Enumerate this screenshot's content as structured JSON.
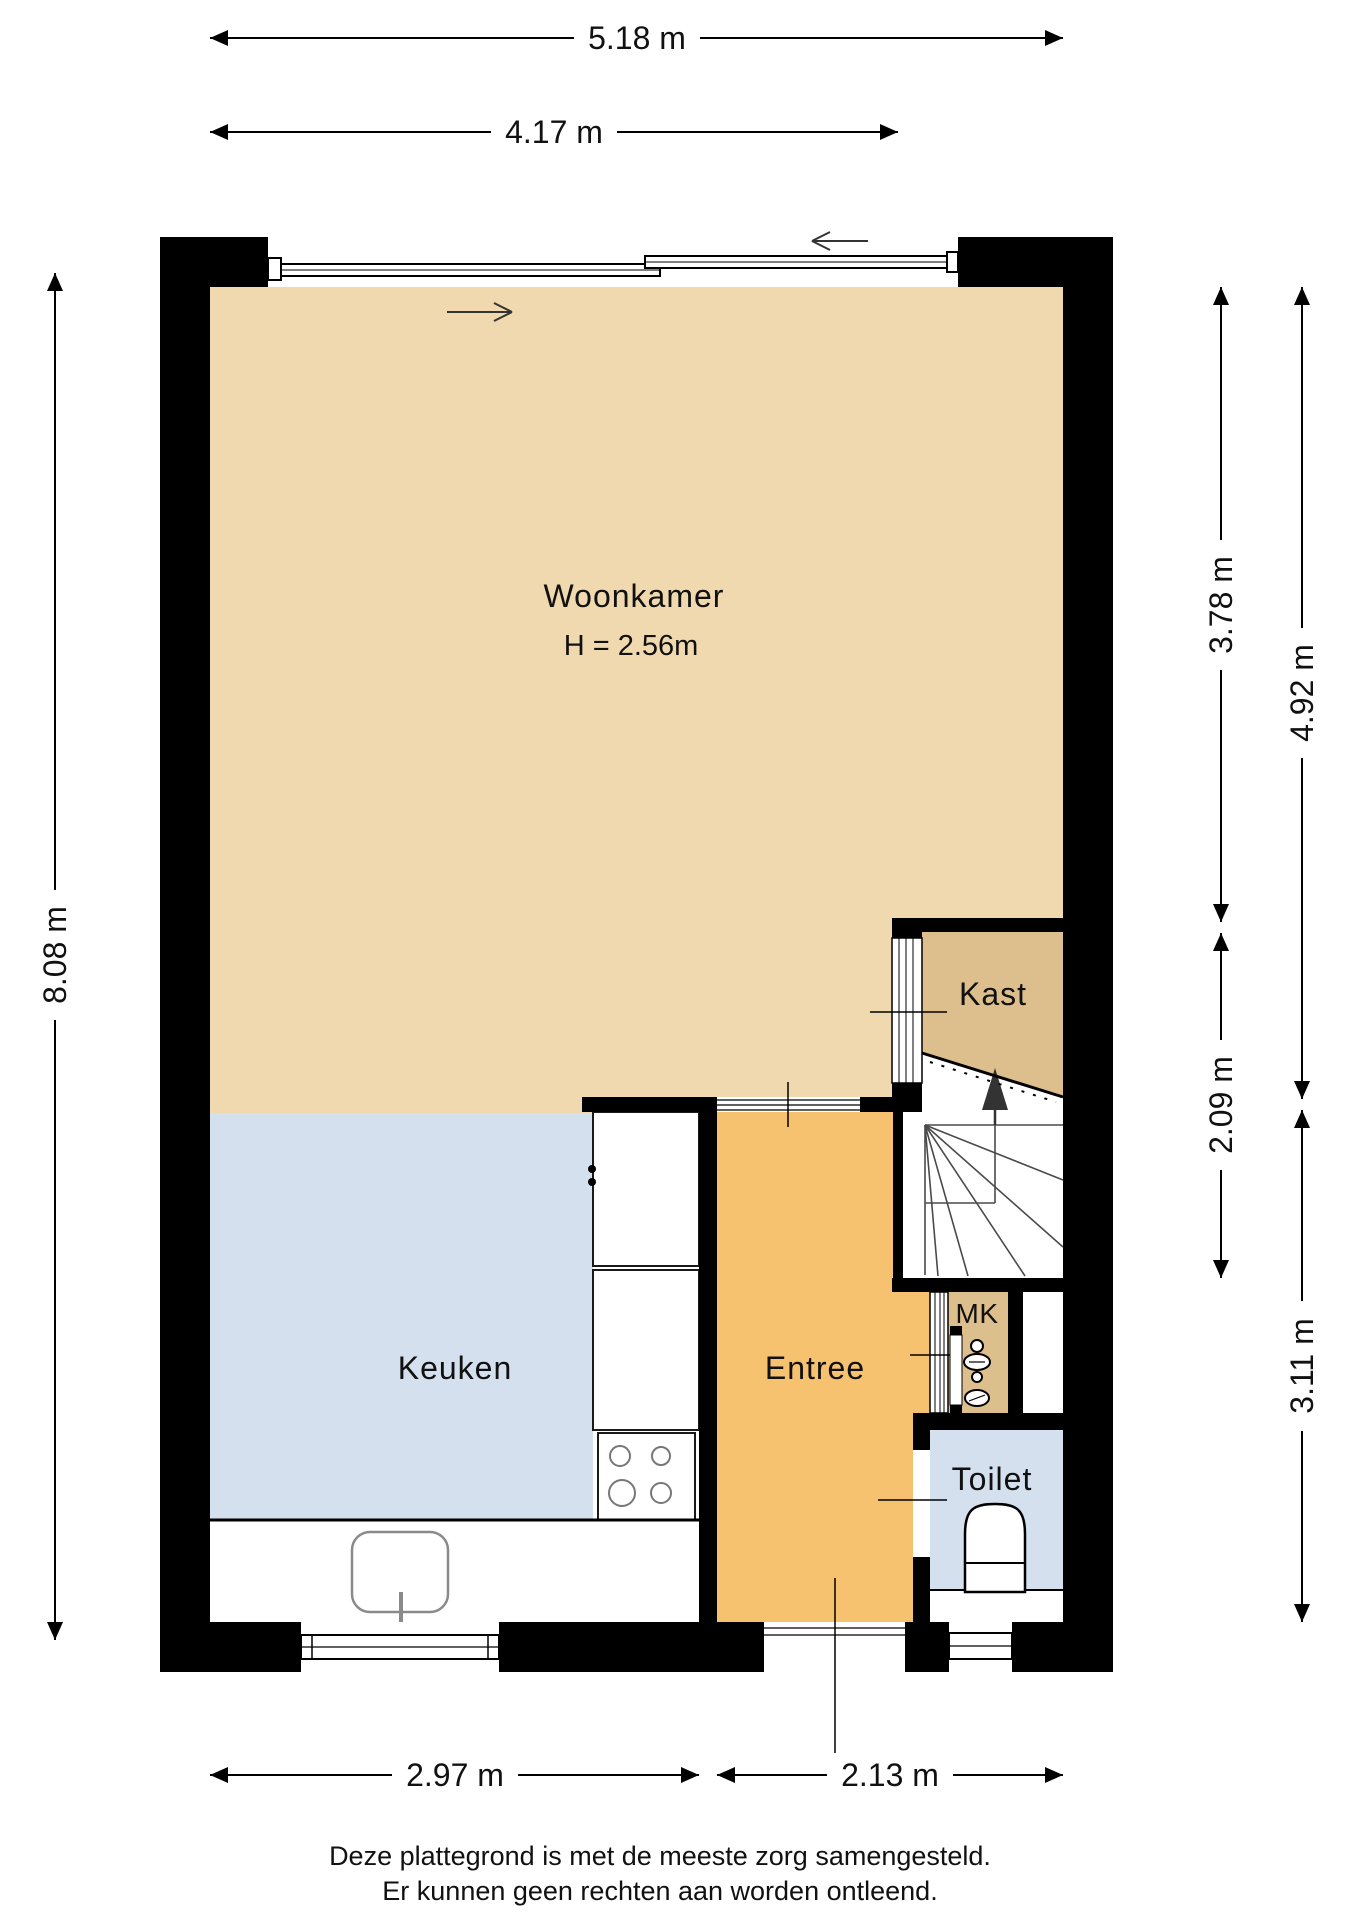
{
  "rooms": {
    "woonkamer": {
      "label": "Woonkamer",
      "height_note": "H = 2.56m"
    },
    "keuken": {
      "label": "Keuken"
    },
    "entree": {
      "label": "Entree"
    },
    "kast": {
      "label": "Kast"
    },
    "mk": {
      "label": "MK"
    },
    "toilet": {
      "label": "Toilet"
    }
  },
  "dimensions": {
    "top_total": "5.18 m",
    "top_window": "4.17 m",
    "left_total": "8.08 m",
    "right_inner_upper": "3.78 m",
    "right_inner_mid": "2.09 m",
    "right_outer_upper": "4.92 m",
    "right_outer_lower": "3.11 m",
    "bottom_kitchen": "2.97 m",
    "bottom_entry": "2.13 m"
  },
  "footer": {
    "line1": "Deze plattegrond is met de meeste zorg samengesteld.",
    "line2": "Er kunnen geen rechten aan worden ontleend."
  },
  "colors": {
    "woonkamer": "#F0D9AE",
    "kast": "#DDBE8D",
    "keuken": "#D4E0EE",
    "entree": "#F7C270",
    "wall": "#000000",
    "line": "#1A1A1A"
  }
}
